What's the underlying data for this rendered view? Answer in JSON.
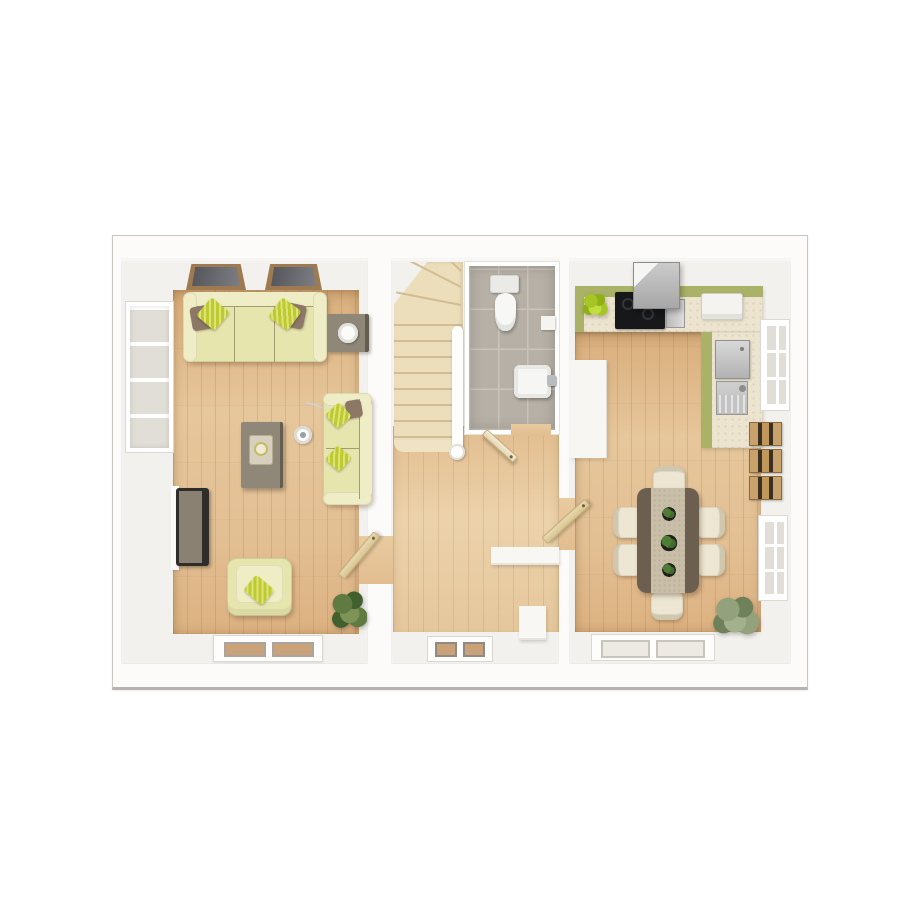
{
  "palette": {
    "page_bg": "#ffffff",
    "plan_bg": "#fcfbfa",
    "plan_edge": "#c9c6c1",
    "wall": "#f3f1ed",
    "wood": "#e0ba8c",
    "carpet": "#ecdebb",
    "carpet_line": "#d2bc92",
    "tile": "#b6b0a6",
    "tile_line": "#c9c4bb",
    "glass": "#e0ded6",
    "win_frame": "#ffffff",
    "win_dark": "#54555b",
    "trim": "#9e7a50",
    "sofa": "#e7e5ae",
    "sofa_light": "#efedc6",
    "sofa_line": "#a09d72",
    "cushion_green": "#bfca2f",
    "cushion_green_lt": "#dce37a",
    "cushion_brown": "#8d7767",
    "gray_table": "#8f8778",
    "gray_table_edge": "#655d4f",
    "tv_frame": "#2f2d2a",
    "tv_back": "#8b8172",
    "dining_dark": "#6c5f50",
    "runner": "#c9bfa8",
    "chair": "#ece6d3",
    "chair_line": "#cfc7ae",
    "counter": "#ece4cf",
    "counter_green": "#a9b266",
    "steel": "#c6c6c6",
    "hob": "#17181a",
    "door": "#e8d9b2",
    "door_edge": "#c4ae79",
    "plant": "#5f7b41",
    "plant_dark": "#41602e",
    "plant_mid": "#7e9456",
    "plant_lime": "#a6c424",
    "plant_sage": "#93a17c",
    "mat_tan": "#c9a279"
  },
  "floorplan": {
    "view": "top-down 3d render, ground floor",
    "rooms": [
      {
        "label": "living room",
        "floor": "oak plank",
        "items": [
          "three-seat sofa with striped green and brown cushions",
          "side table with round lamp",
          "coffee table with tray and candle plate",
          "arc floor lamp",
          "two-seat loveseat",
          "wall tv",
          "armchair with green cushion",
          "corner potted plant",
          "two dark front windows",
          "tall side window",
          "rear window",
          "open door"
        ]
      },
      {
        "label": "hallway",
        "floor": "oak plank",
        "items": [
          "carpeted staircase with winders",
          "white banister and newel post",
          "glazed front door",
          "partition walls",
          "open doors"
        ]
      },
      {
        "label": "wc",
        "floor": "grey tile",
        "items": [
          "toilet",
          "wash basin with tap",
          "wall shelf",
          "open door"
        ]
      },
      {
        "label": "kitchen dining room",
        "floor": "oak plank",
        "items": [
          "l-shaped worktop with green edge",
          "black hob",
          "extractor hood",
          "white counter appliance",
          "stainless unit",
          "sink with tap",
          "tall white unit",
          "lime potted plant",
          "dining table with dark ends and runner",
          "six cream chairs",
          "three table plants",
          "three wooden wall shelves",
          "two side windows",
          "patio door",
          "corner sage plant",
          "open door"
        ]
      }
    ],
    "counts": {
      "dining_chairs": 6,
      "table_plants": 3,
      "wall_shelves": 3,
      "front_windows": 2,
      "stair_treads": 8
    }
  }
}
